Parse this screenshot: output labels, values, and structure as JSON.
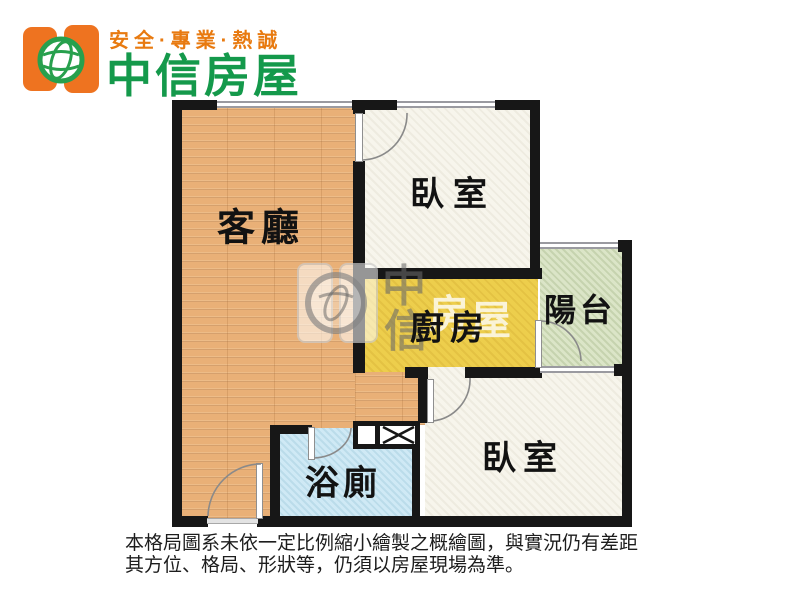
{
  "header": {
    "slogan": "安全·專業·熱誠",
    "brand": "中信房屋",
    "brand_color": "#14994b",
    "accent_orange": "#ee7320"
  },
  "floorplan": {
    "rooms": [
      {
        "id": "living-room",
        "label": "客廳",
        "floor_color": "#e9b077"
      },
      {
        "id": "bedroom-top",
        "label": "臥室",
        "floor_color": "#f7f5ec"
      },
      {
        "id": "kitchen",
        "label": "廚房",
        "floor_color": "#edce4c"
      },
      {
        "id": "balcony",
        "label": "陽台",
        "floor_color": "#dbe5c7"
      },
      {
        "id": "bedroom-bottom",
        "label": "臥室",
        "floor_color": "#f7f5ec"
      },
      {
        "id": "bathroom",
        "label": "浴廁",
        "floor_color": "#cfe9f5"
      }
    ],
    "wall_color": "#171717",
    "watermark": {
      "char1": "中",
      "char2": "信",
      "char3": "房",
      "char4": "屋"
    }
  },
  "disclaimer": {
    "line1": "本格局圖系未依一定比例縮小繪製之概繪圖，與實況仍有差距",
    "line2": "其方位、格局、形狀等，仍須以房屋現場為準。"
  }
}
